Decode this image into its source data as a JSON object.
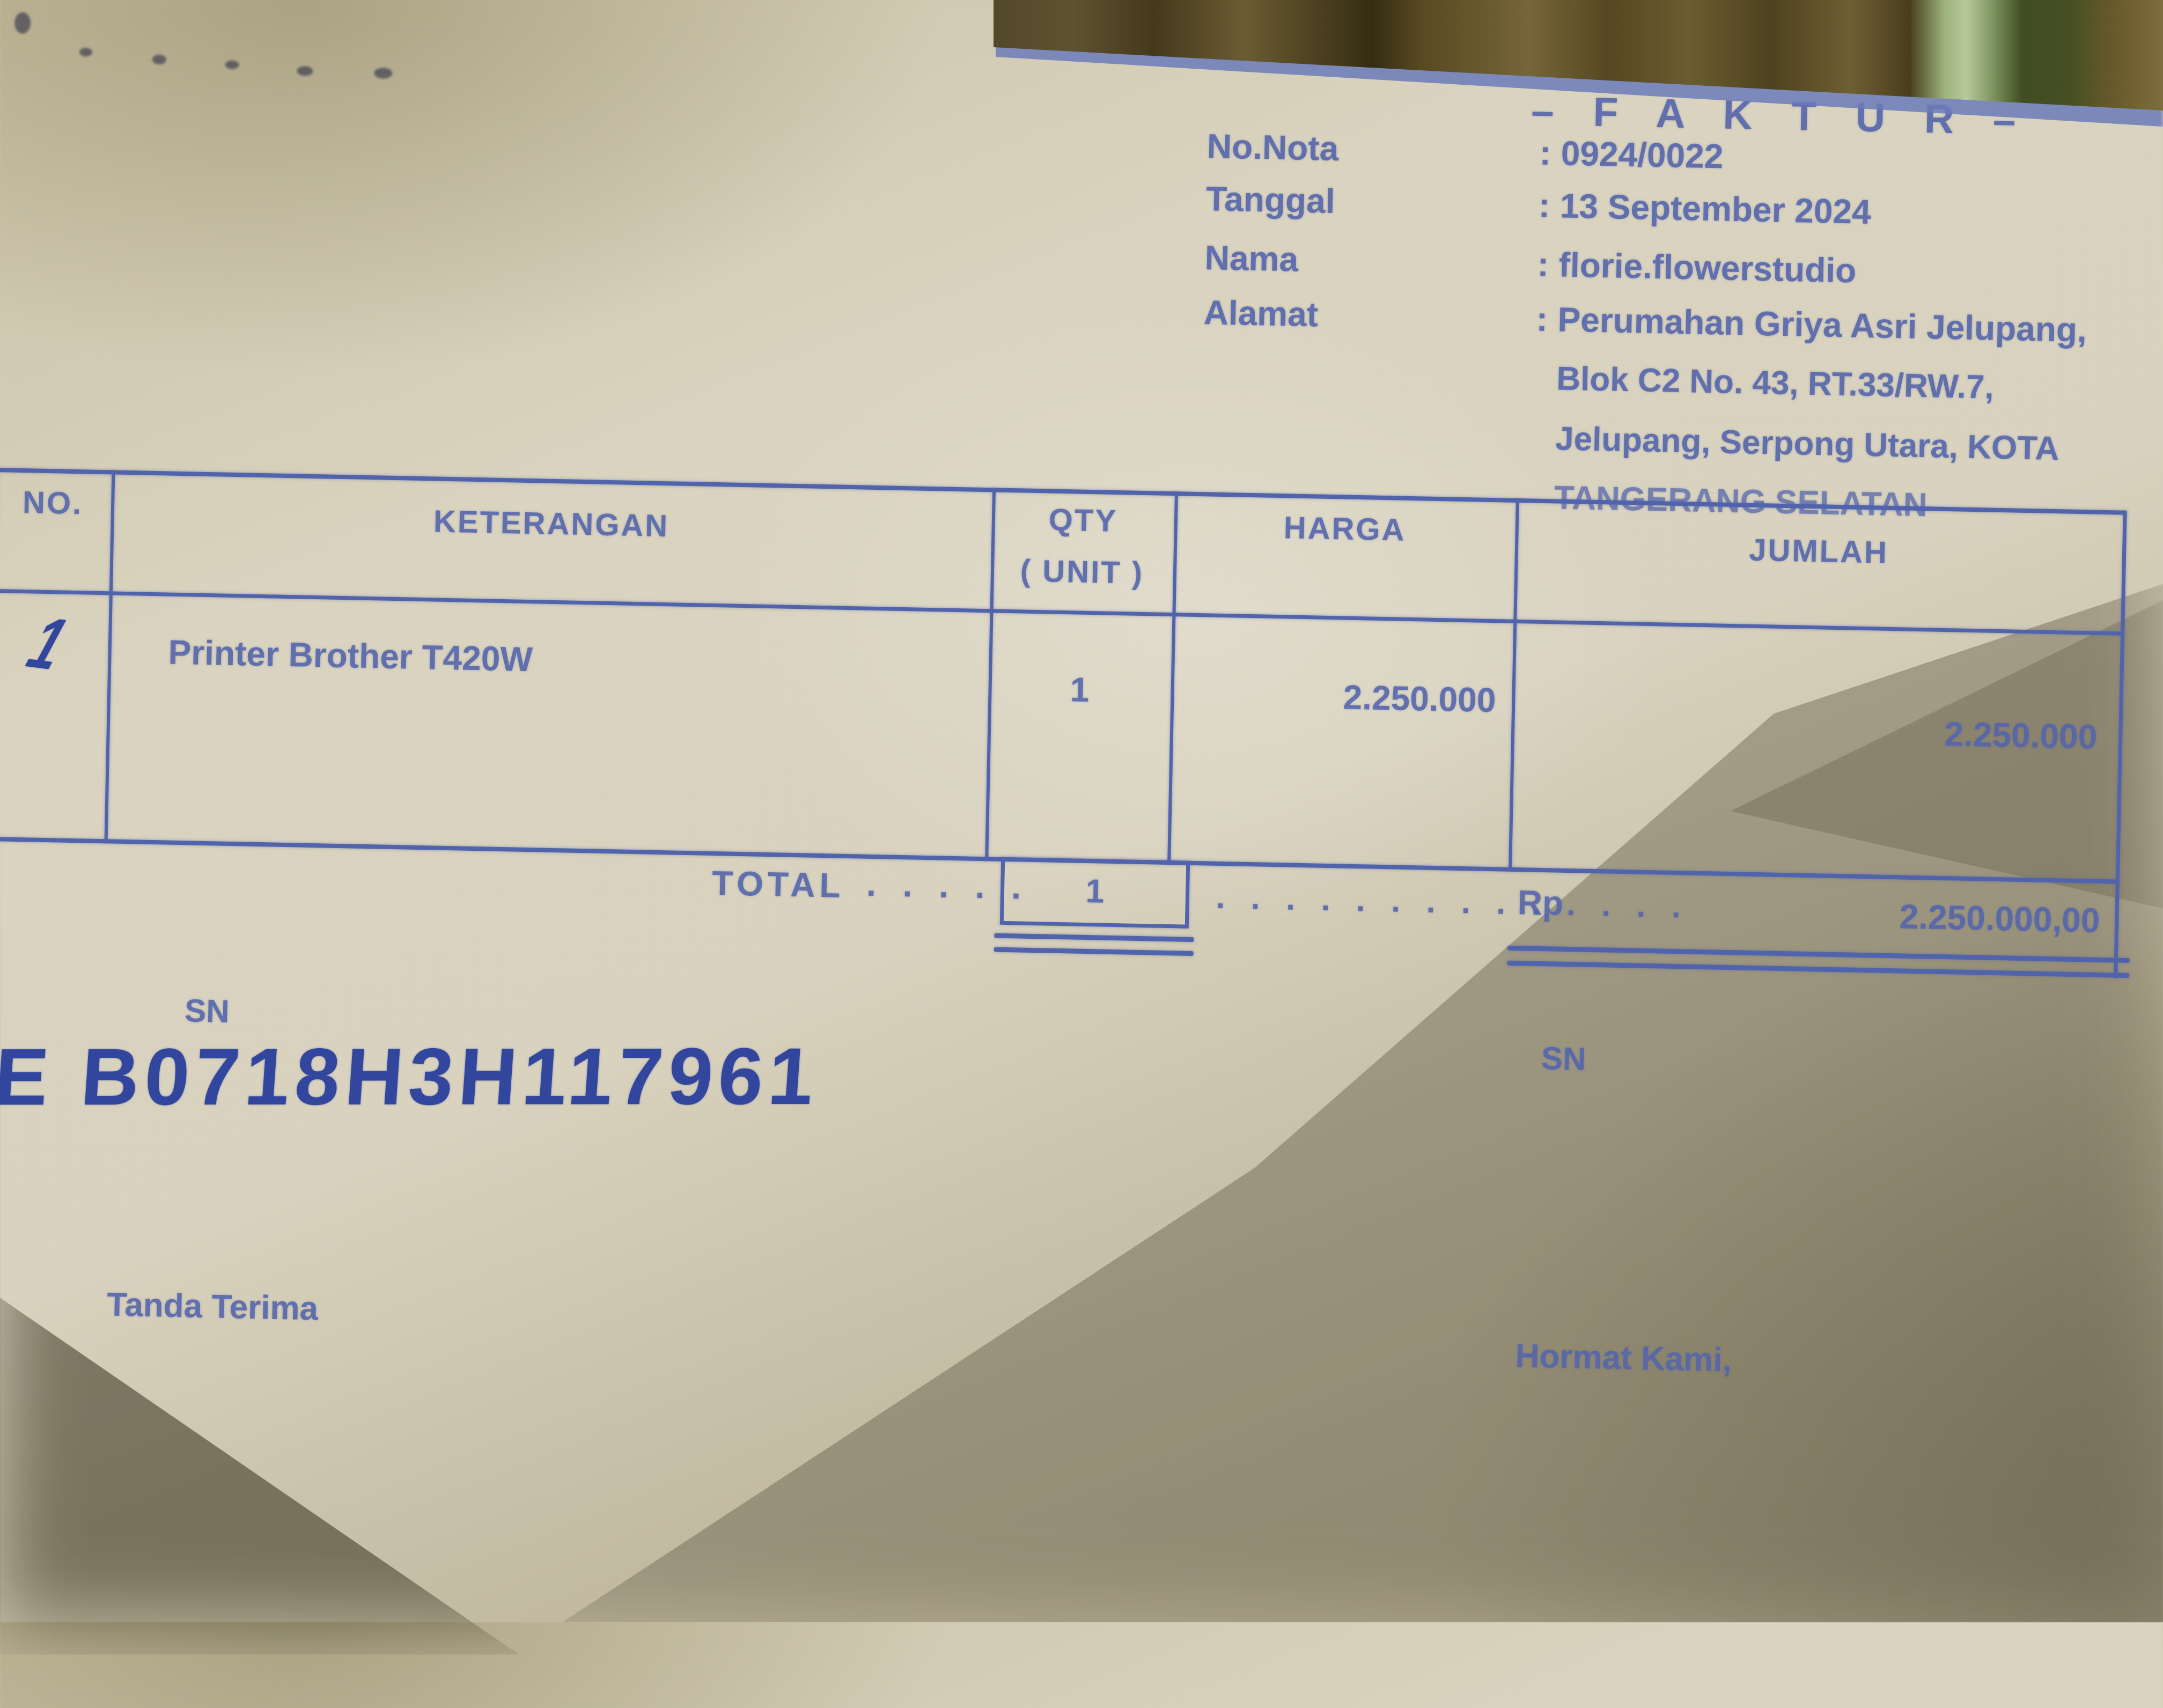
{
  "header": {
    "title": "– F A K T U R –",
    "fields": [
      {
        "label": "No.Nota",
        "colon": ":",
        "value": "0924/0022"
      },
      {
        "label": "Tanggal",
        "colon": ":",
        "value": "13 September 2024"
      },
      {
        "label": "Nama",
        "colon": ":",
        "value": "florie.flowerstudio"
      },
      {
        "label": "Alamat",
        "colon": ":",
        "value": "Perumahan Griya Asri Jelupang,"
      }
    ],
    "address_lines": [
      "Blok C2 No. 43, RT.33/RW.7,",
      "Jelupang, Serpong Utara, KOTA",
      "TANGERANG SELATAN"
    ]
  },
  "table": {
    "header": {
      "no": "NO.",
      "keterangan": "KETERANGAN",
      "qty_line1": "QTY",
      "qty_line2": "( UNIT )",
      "harga": "HARGA",
      "jumlah": "JUMLAH"
    },
    "rows": [
      {
        "no": "1",
        "keterangan": "Printer Brother T420W",
        "qty": "1",
        "harga": "2.250.000",
        "jumlah": "2.250.000"
      }
    ],
    "total": {
      "label": "TOTAL",
      "leader1": ". . . . .",
      "qty": "1",
      "leader2": ". . . . . . . . . . . . . .",
      "currency": "Rp",
      "amount": "2.250.000,00"
    }
  },
  "serial": {
    "label_left": "SN",
    "value": "E B0718H3H117961",
    "label_right": "SN"
  },
  "footer": {
    "left": "Tanda Terima",
    "right": "Hormat Kami,"
  },
  "colors": {
    "ink_blue": "#5565ab",
    "handwriting_blue": "#32469e",
    "paper": "#d8d2be",
    "background_wood": "#53482a",
    "background_green_strip": "#b7c79a"
  }
}
